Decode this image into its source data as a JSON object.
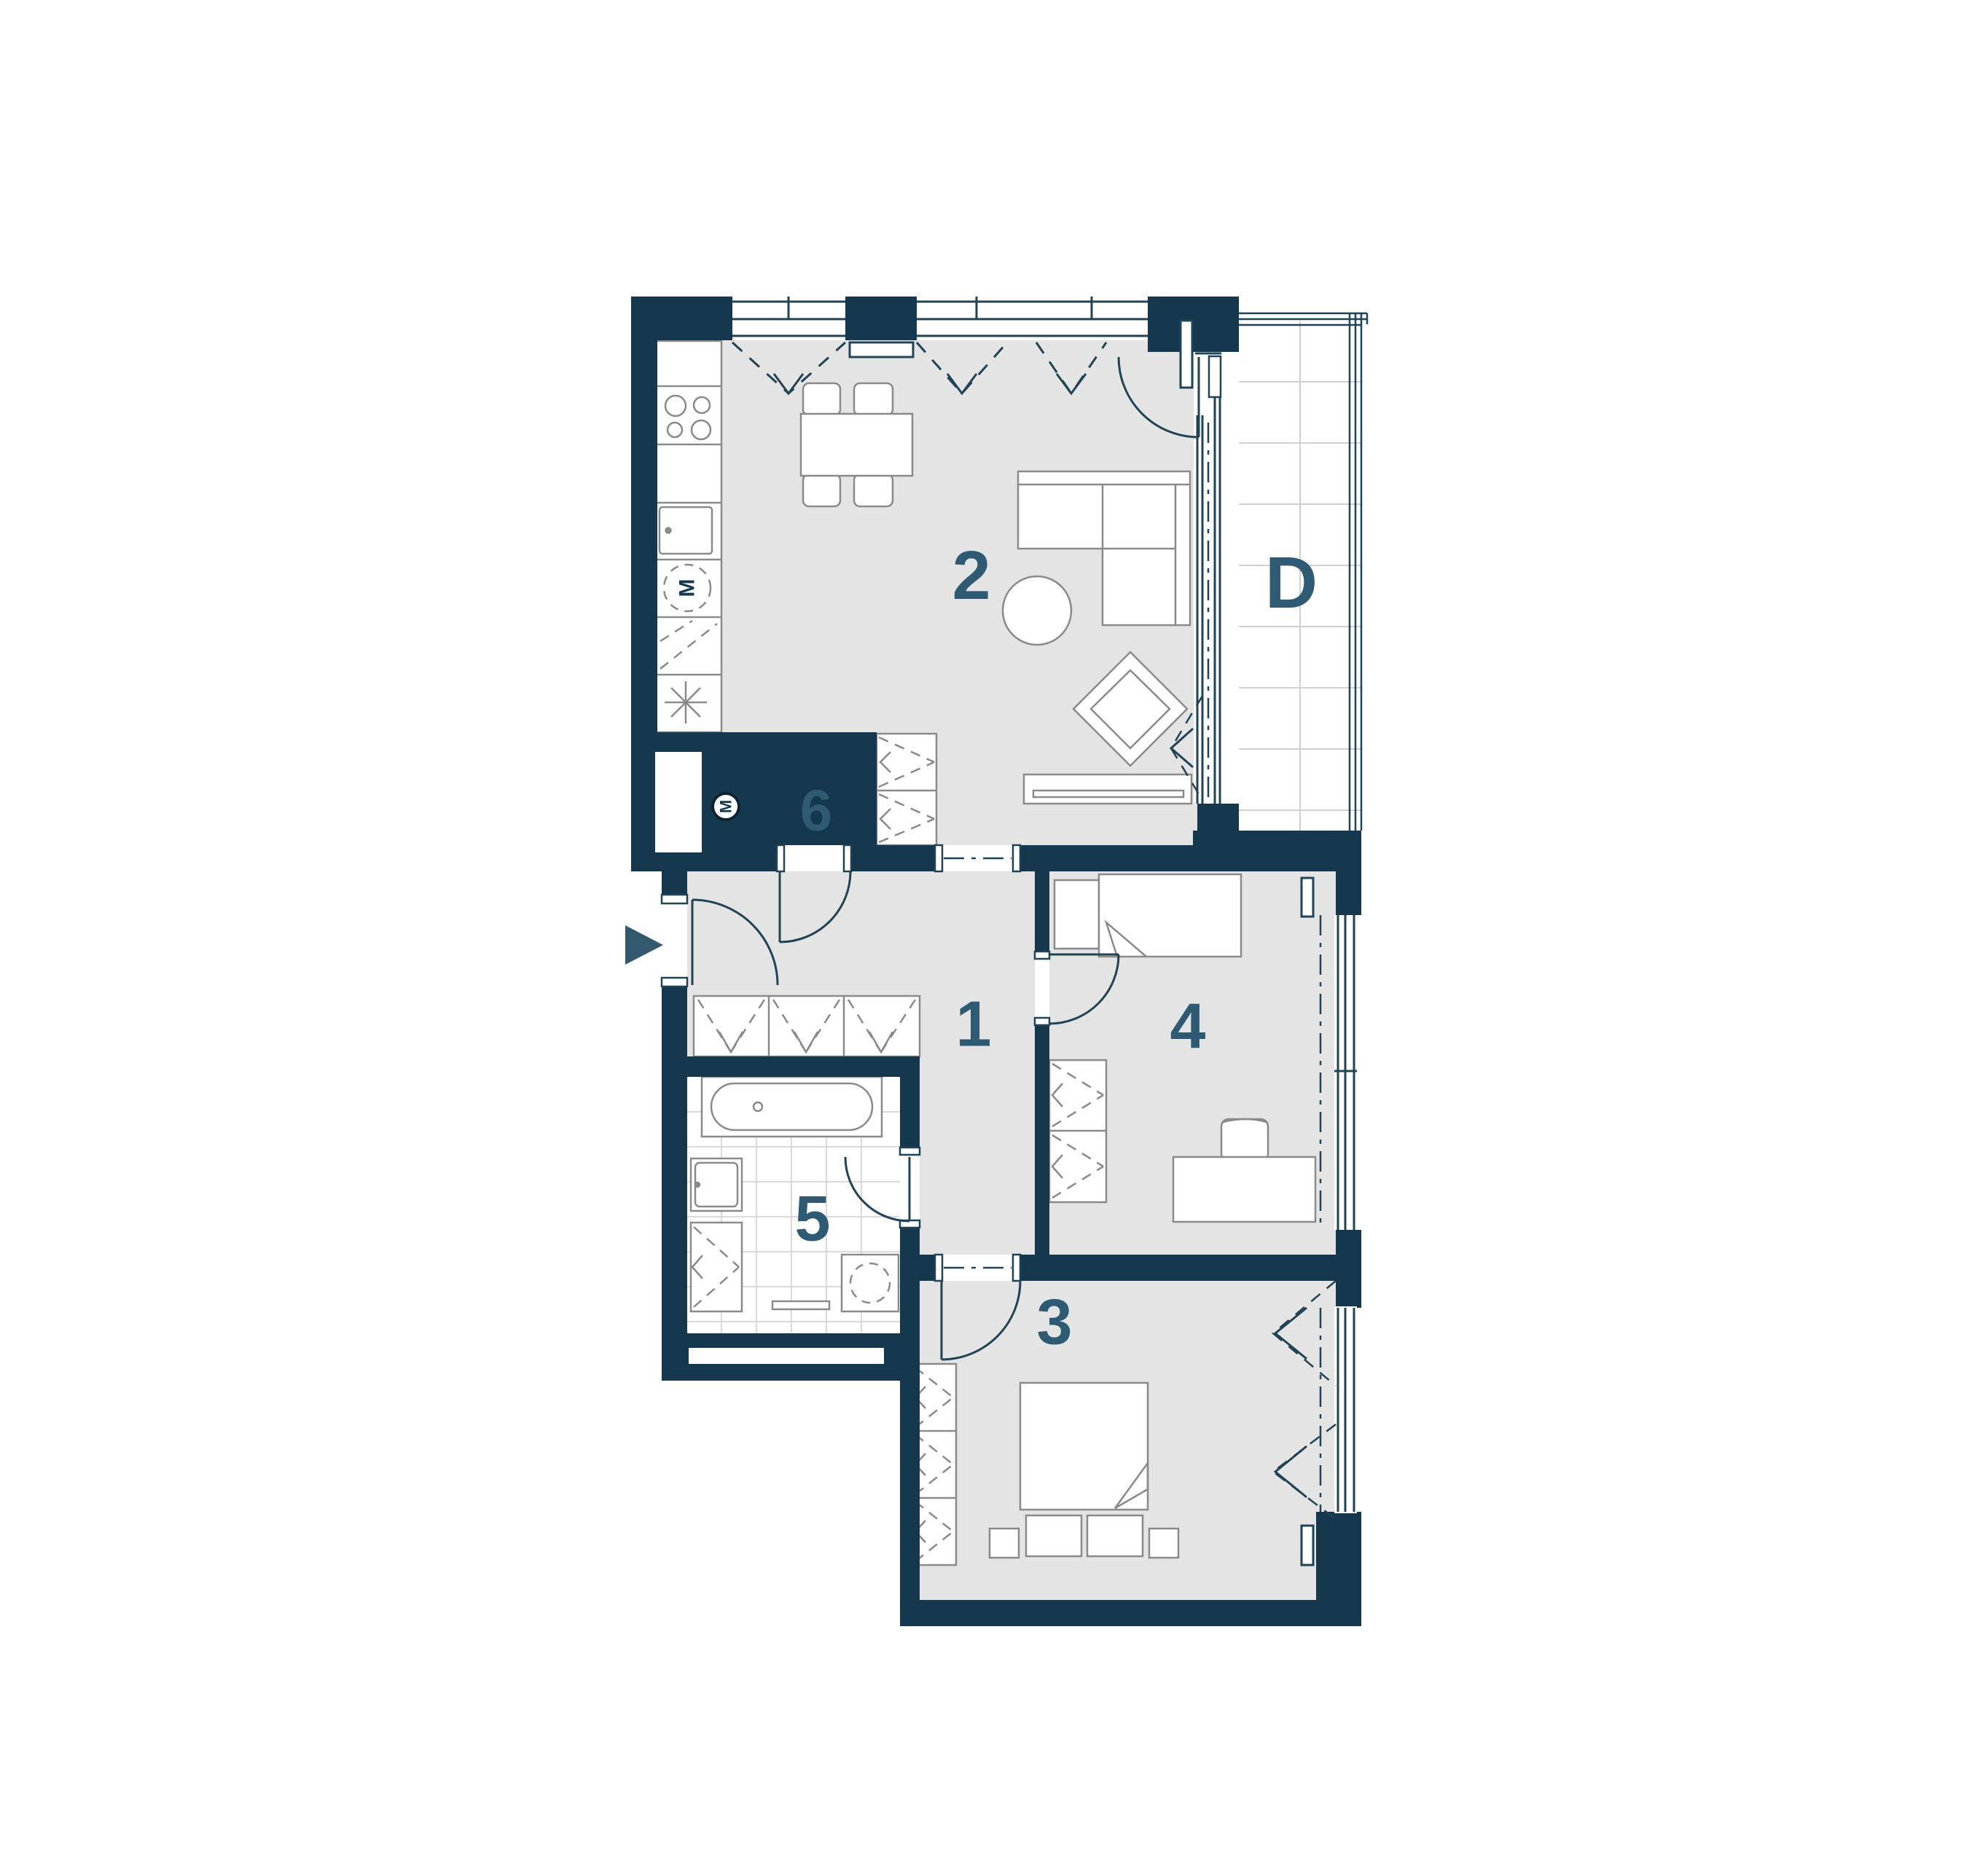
{
  "floor_plan": {
    "room_labels": {
      "living_kitchen": "2",
      "balcony": "D",
      "wc": "6",
      "hall": "1",
      "bedroom_small": "4",
      "bathroom": "5",
      "bedroom_large": "3"
    },
    "symbols": {
      "washing_machine": "M",
      "fan": "M"
    },
    "colors": {
      "wall": "#16384e",
      "floor": "#e4e4e4",
      "room_label": "#2e5a74",
      "furniture_line": "#8a8a8a",
      "plan_line": "#204356",
      "tile_line": "#dadada",
      "entrance_arrow": "#33596e"
    }
  }
}
